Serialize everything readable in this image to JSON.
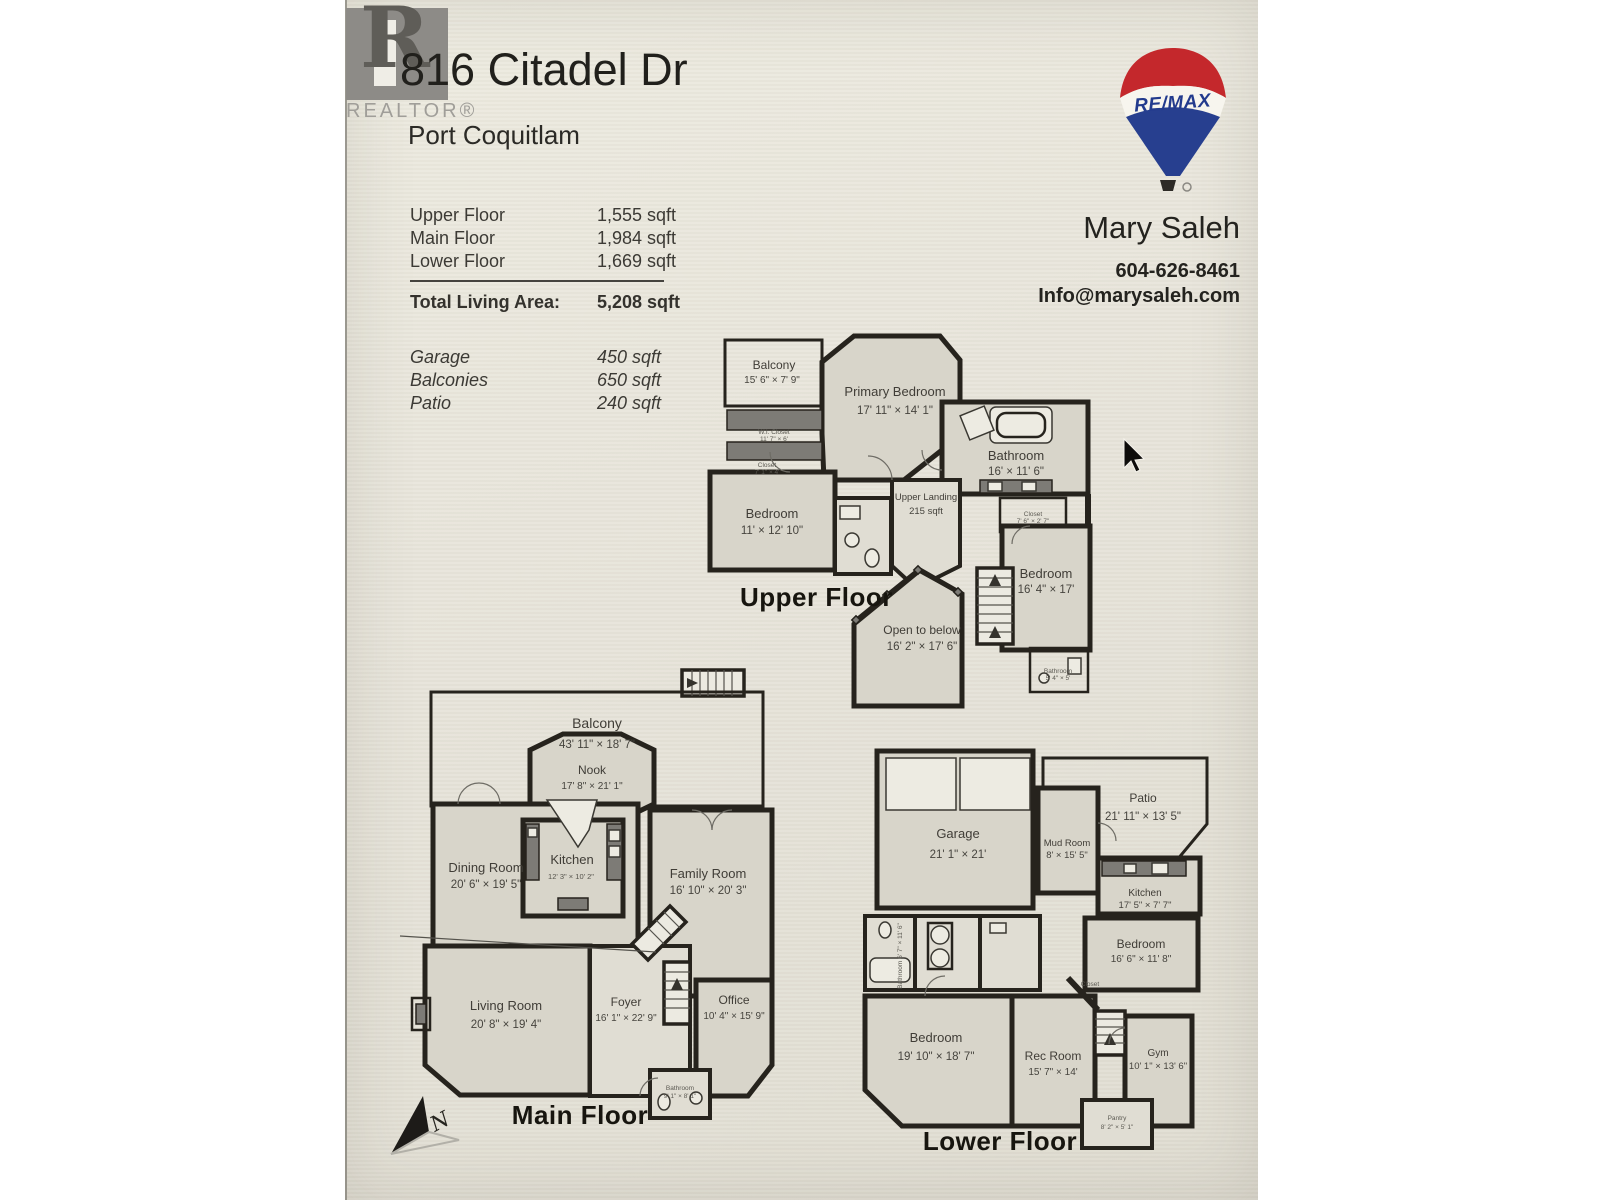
{
  "header": {
    "realtor": {
      "letter": "R",
      "label": "REALTOR®"
    },
    "address": "816 Citadel Dr",
    "city": "Port Coquitlam"
  },
  "areas": {
    "rows": [
      {
        "label": "Upper Floor",
        "value": "1,555 sqft"
      },
      {
        "label": "Main Floor",
        "value": "1,984 sqft"
      },
      {
        "label": "Lower Floor",
        "value": "1,669 sqft"
      }
    ],
    "total_label": "Total Living Area:",
    "total_value": "5,208 sqft",
    "extras": [
      {
        "label": "Garage",
        "value": "450 sqft"
      },
      {
        "label": "Balconies",
        "value": "650 sqft"
      },
      {
        "label": "Patio",
        "value": "240 sqft"
      }
    ]
  },
  "agent": {
    "brand": "RE/MAX",
    "name": "Mary Saleh",
    "phone": "604-626-8461",
    "email": "Info@marysaleh.com"
  },
  "floors": {
    "upper": {
      "title": "Upper Floor",
      "rooms": {
        "balcony": {
          "name": "Balcony",
          "dims": "15' 6\" × 7' 9\""
        },
        "primary": {
          "name": "Primary Bedroom",
          "dims": "17' 11\" × 14' 1\""
        },
        "bathroom": {
          "name": "Bathroom",
          "dims": "16' × 11' 6\""
        },
        "wi_closet": {
          "name": "W.I. Closet",
          "dims": "11' 7\" × 6'"
        },
        "closet_a": {
          "name": "Closet",
          "dims": "7' 1\" × 4'"
        },
        "bedroom_left": {
          "name": "Bedroom",
          "dims": "11' × 12' 10\""
        },
        "landing": {
          "name": "Upper Landing",
          "dims": "215 sqft"
        },
        "closet_b": {
          "name": "Closet",
          "dims": "7' 6\" × 2' 7\""
        },
        "bedroom_right": {
          "name": "Bedroom",
          "dims": "16' 4\" × 17'"
        },
        "open_below": {
          "name": "Open to below",
          "dims": "16' 2\" × 17' 6\""
        },
        "bathroom_small": {
          "name": "Bathroom",
          "dims": "5' 4\" × 5'"
        }
      }
    },
    "main": {
      "title": "Main Floor",
      "rooms": {
        "balcony": {
          "name": "Balcony",
          "dims": "43' 11\" × 18' 7\""
        },
        "nook": {
          "name": "Nook",
          "dims": "17' 8\" × 21' 1\""
        },
        "dining": {
          "name": "Dining Room",
          "dims": "20' 6\" × 19' 5\""
        },
        "kitchen": {
          "name": "Kitchen",
          "dims": "12' 3\" × 10' 2\""
        },
        "family": {
          "name": "Family Room",
          "dims": "16' 10\" × 20' 3\""
        },
        "living": {
          "name": "Living Room",
          "dims": "20' 8\" × 19' 4\""
        },
        "foyer": {
          "name": "Foyer",
          "dims": "16' 1\" × 22' 9\""
        },
        "office": {
          "name": "Office",
          "dims": "10' 4\" × 15' 9\""
        },
        "bathroom": {
          "name": "Bathroom",
          "dims": "9' 1\" × 8' 1\""
        }
      }
    },
    "lower": {
      "title": "Lower Floor",
      "rooms": {
        "garage": {
          "name": "Garage",
          "dims": "21' 1\" × 21'"
        },
        "patio": {
          "name": "Patio",
          "dims": "21' 11\" × 13' 5\""
        },
        "mud": {
          "name": "Mud Room",
          "dims": "8' × 15' 5\""
        },
        "kitchen": {
          "name": "Kitchen",
          "dims": "17' 5\" × 7' 7\""
        },
        "bedroom_right": {
          "name": "Bedroom",
          "dims": "16' 6\" × 11' 8\""
        },
        "bathroom": {
          "name": "Bathroom 6' 7\" × 11' 6\"",
          "dims": ""
        },
        "bedroom_big": {
          "name": "Bedroom",
          "dims": "19' 10\" × 18' 7\""
        },
        "rec": {
          "name": "Rec Room",
          "dims": "15' 7\" × 14'"
        },
        "gym": {
          "name": "Gym",
          "dims": "10' 1\" × 13' 6\""
        },
        "pantry": {
          "name": "Pantry",
          "dims": "8' 2\" × 5' 1\""
        },
        "closet": {
          "name": "Closet",
          "dims": ""
        }
      }
    }
  },
  "compass": {
    "letter": "N"
  },
  "colors": {
    "page": "#e8e5db",
    "wall": "#26231d",
    "room_fill": "#d8d5ca",
    "remax_red": "#c4282c",
    "remax_blue": "#273f8f",
    "logo_gray": "#8d8b87"
  }
}
